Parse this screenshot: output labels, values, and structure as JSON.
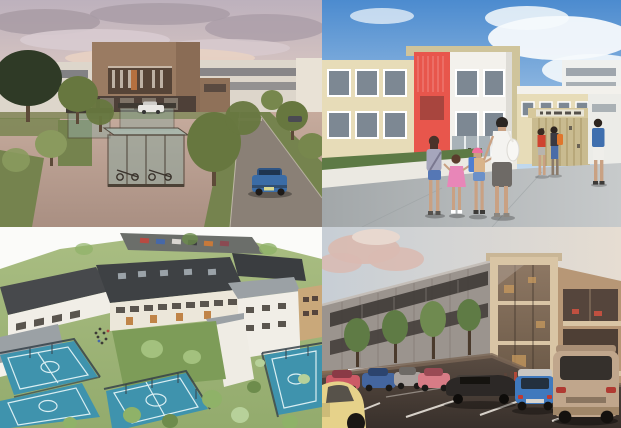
{
  "collage": {
    "title": "Collage of four architectural renderings of a school campus",
    "grid": {
      "columns": 2,
      "rows": 2,
      "split_x": 322,
      "split_y": 227
    },
    "panels": [
      {
        "id": "street-view-dusk",
        "description": "Dusk street view: tan central building flanked by white blocks, tree-lined plaza with glazed cycle shelters, road with a blue car and a white parked car"
      },
      {
        "id": "school-entrance",
        "description": "Daytime view: cream two-storey school with red feature panel and white blocks; a mother and three children walk toward the entrance gates; pupils by the gate and a man at right"
      },
      {
        "id": "aerial-campus",
        "description": "Aerial view: white school buildings with dark roofs around a courtyard lawn, fenced blue sports courts, lawns and trees, small car park behind"
      },
      {
        "id": "car-park-dusk",
        "description": "Dusk car park: rows of parked cars in front of a three-storey grey-clad building with a tall warm glazed atrium and open upper floors"
      }
    ],
    "objects": {
      "street_view_cars": [
        "white parked car",
        "blue estate car",
        "distant dark car"
      ],
      "entrance_people": [
        "mother in white top and grey skirt",
        "girl in grey top and blue shorts",
        "toddler in pink dress",
        "girl with pink helmet and blue backpack",
        "pupil with red top",
        "pupil with orange backpack",
        "man in blue t-shirt"
      ],
      "aerial_features": [
        "blue sports courts with white markings",
        "courtyard lawn",
        "dark roofs with skylights",
        "perimeter fences",
        "car park with parked cars"
      ],
      "car_park_cars": [
        "yellow hatchback",
        "red car",
        "blue car",
        "silver car",
        "pink car",
        "black sedan",
        "blue mini",
        "beige SUV"
      ]
    }
  },
  "palette": {
    "tl_sky_top": "#bdb1bd",
    "tl_sky_low": "#e8d2c3",
    "tl_cloud": "#a89ba5",
    "tl_cloud_light": "#d8cbd0",
    "tl_building_tan": "#9a7b62",
    "tl_building_dark": "#564437",
    "tl_white_bld": "#ddd6cb",
    "tl_plaza": "#c6ab9d",
    "tl_plaza_dark": "#a98f82",
    "tl_road": "#8a8076",
    "tl_grass": "#75834e",
    "tl_tree": "#67773f",
    "tl_tree_dark": "#2f3a26",
    "tl_glass": "#93a89e",
    "tl_frame": "#4b4136",
    "tl_car_blue": "#3a6ca6",
    "tl_car_white": "#e9e7e3",
    "tr_sky_top": "#4c8bcf",
    "tr_sky_low": "#c3daee",
    "tr_cloud": "#f5f9fc",
    "tr_cream": "#e7dcb8",
    "tr_tan": "#cfc49b",
    "tr_red": "#e8564c",
    "tr_white": "#f3f1ec",
    "tr_window": "#7d8893",
    "tr_pave": "#c7cacb",
    "tr_pave_dark": "#a2a7a9",
    "tr_wall": "#ebe9e2",
    "tr_hedge": "#5d7a45",
    "tr_gate": "#c9bb90",
    "skin": "#c9a183",
    "tr_skirt": "#6e6a66",
    "tr_pink": "#e886b8",
    "tr_helmet": "#ee6f9e",
    "tr_backpack": "#4f7ed0",
    "tr_orange": "#e0762c",
    "tr_redtop": "#cf4430",
    "tr_jeans": "#4a6da8",
    "bl_bg": "#fbfbf9",
    "bl_grass": "#93ab6d",
    "bl_grass_light": "#a9bd82",
    "bl_roof_dark": "#3e4144",
    "bl_roof_grey": "#9ba1a5",
    "bl_wall_white": "#f1eee7",
    "bl_window": "#5a554e",
    "bl_accent_orange": "#c08448",
    "bl_court": "#3f93ad",
    "bl_court_line": "#d9eef2",
    "bl_fence": "#36424a",
    "bl_tree": "#8fb268",
    "bl_tree_dark": "#6d8c4c",
    "br_sky_left": "#c7ced5",
    "br_sky_right": "#e6ddd2",
    "br_cloud_pink": "#d9bab1",
    "br_clad": "#9b948e",
    "br_window_dark": "#3f3a36",
    "br_frame_cream": "#d9c5a5",
    "br_glass_warm": "#6b5947",
    "br_glass_light": "#8d7763",
    "br_right_tan": "#b79776",
    "br_asphalt": "#5a4c42",
    "br_asphalt_dark": "#38302b",
    "br_line": "#e8e2da",
    "br_tree": "#5f7b45",
    "br_trunk": "#4a3a2c",
    "car_yellow": "#e6d28a",
    "car_red": "#cc5a66",
    "car_blue": "#44669f",
    "car_silver": "#a8a29e",
    "car_pink": "#d87c86",
    "car_black": "#2c2826",
    "car_mini_blue": "#4079bd",
    "car_suv": "#c0a68c"
  }
}
